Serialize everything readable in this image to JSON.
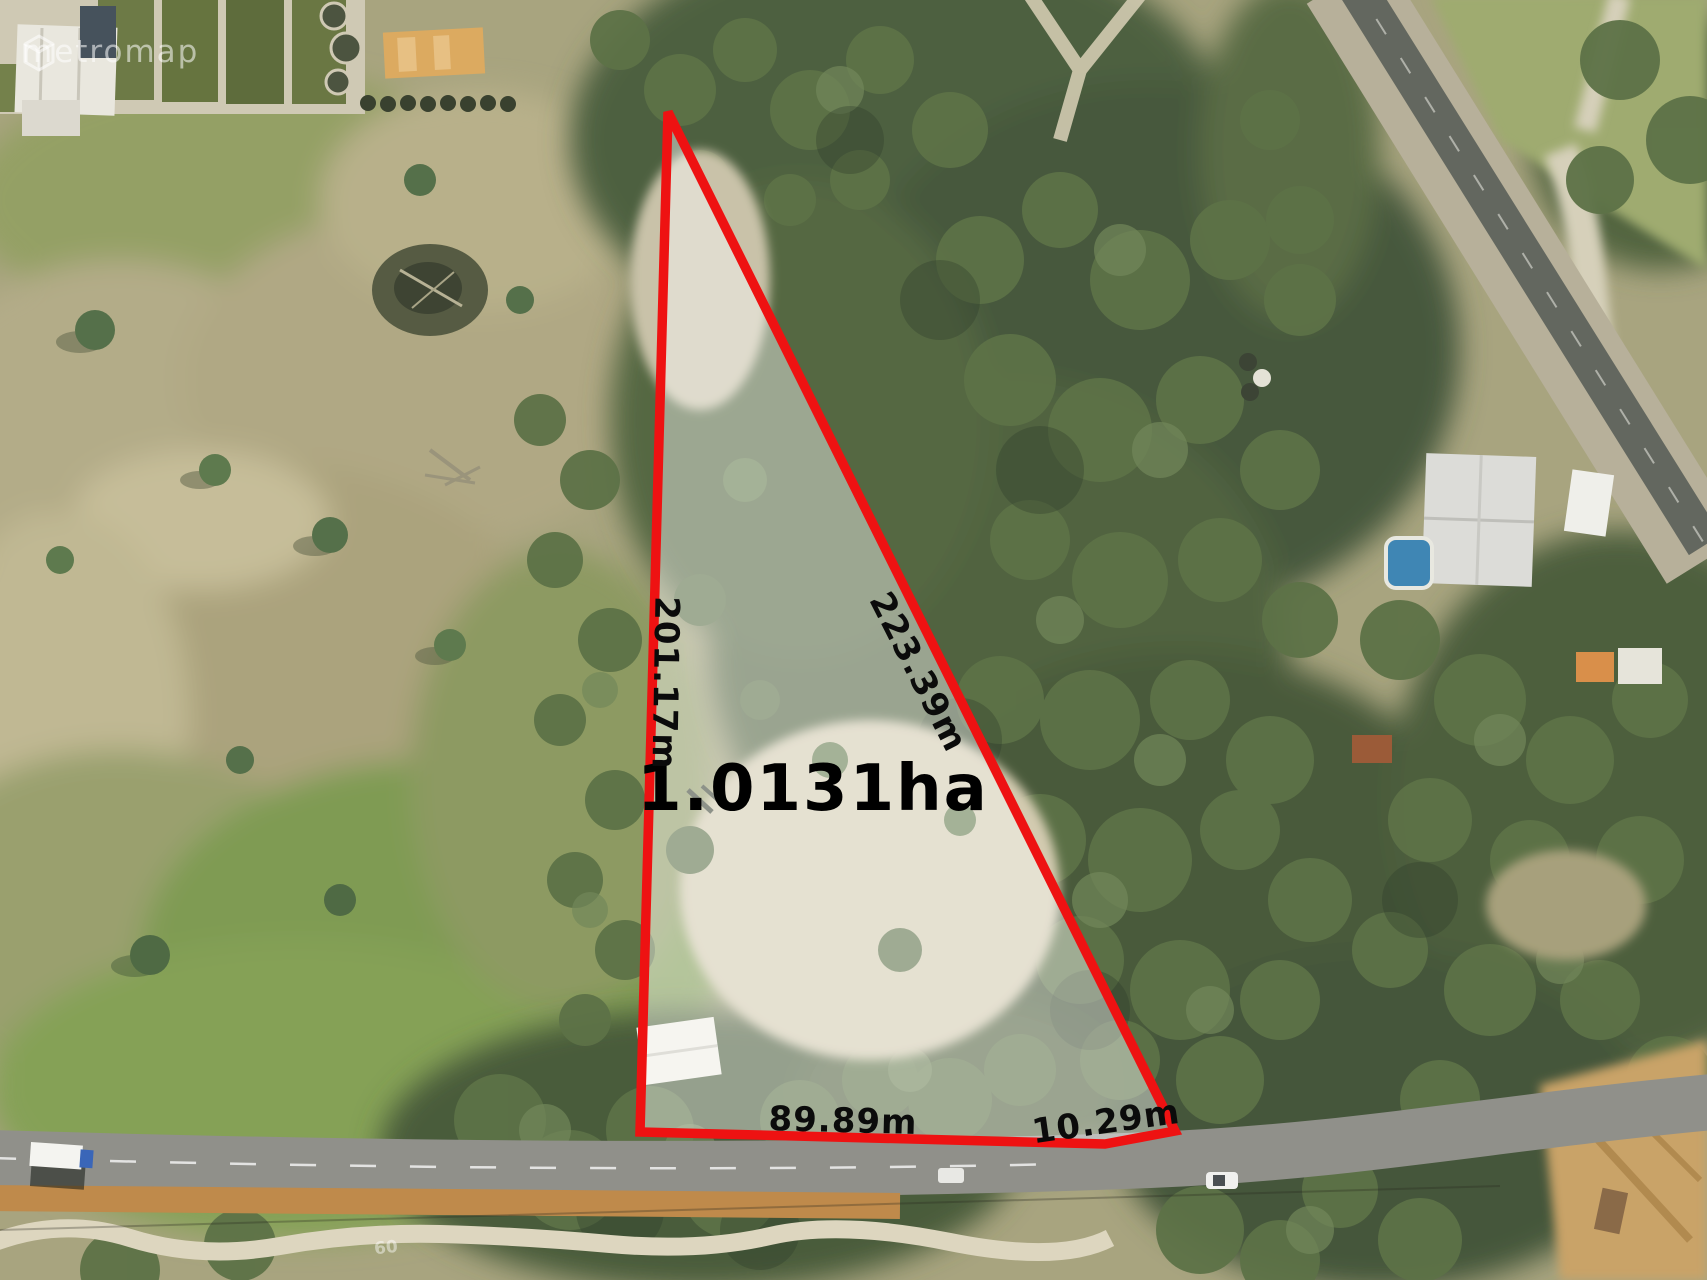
{
  "watermark": {
    "text": "metromap"
  },
  "overlay": {
    "area_label": "1.0131ha",
    "sides": [
      {
        "id": "west-boundary",
        "label": "201.17m"
      },
      {
        "id": "northeast-boundary",
        "label": "223.39m"
      },
      {
        "id": "south-boundary",
        "label": "89.89m"
      },
      {
        "id": "southeast-boundary",
        "label": "10.29m"
      }
    ]
  },
  "road_marking": {
    "text": "60"
  },
  "colors": {
    "boundary_red": "#ee1212",
    "parcel_wash": "rgba(255,255,255,0.42)",
    "label_black": "#0b0b0b",
    "bush_green": "#4c5f3d",
    "paddock_olive": "#a8a47f",
    "road_gray": "#90908a",
    "dirt_orange": "#bf8a4b",
    "pool_blue": "#3f86b4"
  }
}
